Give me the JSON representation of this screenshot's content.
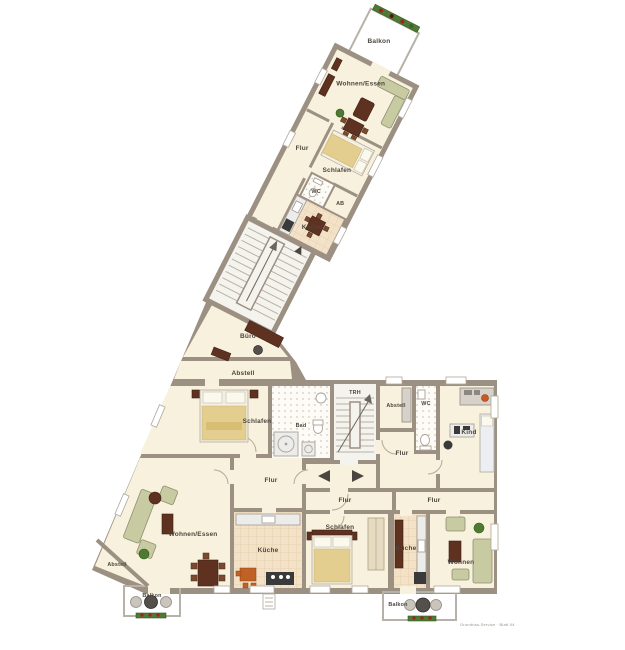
{
  "palette": {
    "wall": "#9c9083",
    "floor": "#f8f1dd",
    "stair_floor": "#f5f3ee",
    "balcony_tile": "#eceae4",
    "kitchen_tile": "#f3e2c8",
    "bath_tile": "#fcfbf6",
    "wood_dark": "#5e3120",
    "sofa_green": "#c8caa2",
    "blanket_tan": "#e3cd8f",
    "plant_green": "#4e7a33",
    "flower_red": "#a02121",
    "chair_orange": "#c06226",
    "label_text": "#4b463f"
  },
  "rooms": {
    "wing": {
      "balkon": "Balkon",
      "wohnen_essen": "Wohnen/Essen",
      "flur": "Flur",
      "schlafen": "Schlafen",
      "wc": "WC",
      "ab": "AB",
      "kueche": "Küche"
    },
    "middle": {
      "buero": "Büro",
      "abstell": "Abstell",
      "schlafen": "Schlafen",
      "bad": "Bad",
      "treppenhaus": "TRH"
    },
    "top_right": {
      "abstell": "Abstell",
      "wc": "WC",
      "kind": "Kind",
      "flur": "Flur"
    },
    "left": {
      "flur": "Flur",
      "wohnen_essen": "Wohnen/Essen",
      "abstell": "Abstell",
      "kueche": "Küche",
      "balkon": "Balkon"
    },
    "bottom": {
      "flur_mid": "Flur",
      "schlafen": "Schlafen",
      "flur_right": "Flur",
      "kueche": "Küche",
      "wohnen": "Wohnen",
      "balkon": "Balkon"
    }
  },
  "footer": {
    "watermark": "Grundriss-Service · Blatt 04"
  }
}
